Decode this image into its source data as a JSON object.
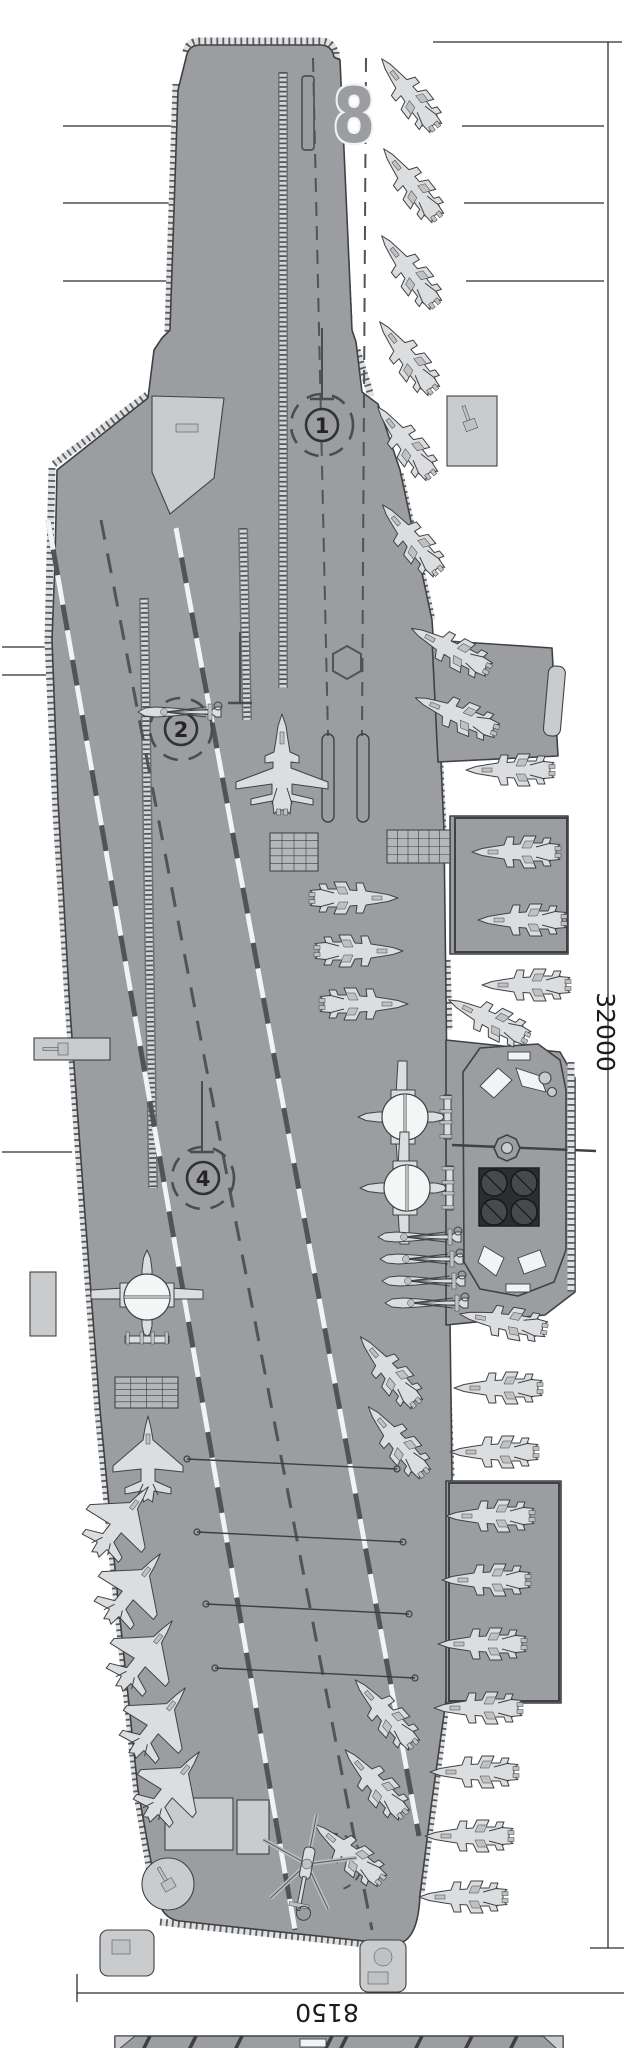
{
  "figure": {
    "title": "aircraft-carrier-flight-deck-plan-top-view",
    "views": [
      "deck-plan",
      "profile-view-cropped-at-bottom"
    ]
  },
  "deck": {
    "bow_number": "8"
  },
  "dimensions": {
    "overall_length": "32000",
    "stern_width": "8150"
  },
  "catapult_spots": [
    {
      "label": "1",
      "x": 322,
      "y": 425,
      "line_x": 322
    },
    {
      "label": "2",
      "x": 181,
      "y": 729,
      "line_x": 240
    },
    {
      "label": "4",
      "x": 203,
      "y": 1178,
      "line_x": 202
    }
  ],
  "colors": {
    "background": "#ffffff",
    "deck": "#9b9da0",
    "deck_light": "#c9cbcd",
    "outline": "#3f4245",
    "aircraft": "#dcdddf",
    "aircraft_shade": "#bfc1c3",
    "marking_white": "#f2f3f4",
    "marking_dark": "#515456",
    "exhaust_block": "#2b2d2e",
    "exhaust_circle": "#47494b"
  },
  "aircraft_inventory": {
    "fighter_wings_folded": 31,
    "fighter_wings_spread": 1,
    "stealth_fighter": 6,
    "aew_radome_aircraft": 3,
    "helicopter_blades_folded": 5,
    "helicopter_rotors_spread": 1
  },
  "aircraft_placements": [
    {
      "t": "flanker_folded",
      "x": 410,
      "y": 95,
      "r": -38
    },
    {
      "t": "flanker_folded",
      "x": 412,
      "y": 185,
      "r": -38
    },
    {
      "t": "flanker_folded",
      "x": 410,
      "y": 272,
      "r": -38
    },
    {
      "t": "flanker_folded",
      "x": 408,
      "y": 358,
      "r": -38
    },
    {
      "t": "flanker_folded",
      "x": 406,
      "y": 443,
      "r": -38
    },
    {
      "t": "flanker_folded",
      "x": 412,
      "y": 540,
      "r": -40
    },
    {
      "t": "flanker_folded",
      "x": 452,
      "y": 650,
      "r": -62
    },
    {
      "t": "flanker_folded",
      "x": 458,
      "y": 715,
      "r": -68
    },
    {
      "t": "flanker_folded",
      "x": 512,
      "y": 770,
      "r": -90
    },
    {
      "t": "flanker_folded",
      "x": 518,
      "y": 852,
      "r": -90
    },
    {
      "t": "flanker_folded",
      "x": 524,
      "y": 920,
      "r": -90
    },
    {
      "t": "flanker_folded",
      "x": 528,
      "y": 985,
      "r": -90
    },
    {
      "t": "flanker_folded",
      "x": 490,
      "y": 1020,
      "r": -64
    },
    {
      "t": "flanker_folded",
      "x": 505,
      "y": 1322,
      "r": -80
    },
    {
      "t": "flanker_folded",
      "x": 500,
      "y": 1388,
      "r": -90
    },
    {
      "t": "flanker_folded",
      "x": 496,
      "y": 1452,
      "r": -90
    },
    {
      "t": "flanker_folded",
      "x": 492,
      "y": 1516,
      "r": -90
    },
    {
      "t": "flanker_folded",
      "x": 488,
      "y": 1580,
      "r": -90
    },
    {
      "t": "flanker_folded",
      "x": 484,
      "y": 1644,
      "r": -90
    },
    {
      "t": "flanker_folded",
      "x": 480,
      "y": 1708,
      "r": -90
    },
    {
      "t": "flanker_folded",
      "x": 476,
      "y": 1772,
      "r": -90
    },
    {
      "t": "flanker_folded",
      "x": 471,
      "y": 1836,
      "r": -90
    },
    {
      "t": "flanker_folded",
      "x": 465,
      "y": 1897,
      "r": -90
    },
    {
      "t": "flanker_folded",
      "x": 390,
      "y": 1372,
      "r": -40
    },
    {
      "t": "flanker_folded",
      "x": 398,
      "y": 1442,
      "r": -40
    },
    {
      "t": "flanker_folded",
      "x": 386,
      "y": 1714,
      "r": -42
    },
    {
      "t": "flanker_folded",
      "x": 376,
      "y": 1784,
      "r": -42
    },
    {
      "t": "flanker_folded",
      "x": 350,
      "y": 1854,
      "r": -50
    },
    {
      "t": "flanker_folded",
      "x": 352,
      "y": 898,
      "r": 90
    },
    {
      "t": "flanker_folded",
      "x": 357,
      "y": 951,
      "r": 90
    },
    {
      "t": "flanker_folded",
      "x": 362,
      "y": 1004,
      "r": 90
    },
    {
      "t": "flanker_spread",
      "x": 282,
      "y": 768,
      "r": 0
    },
    {
      "t": "stealth",
      "x": 148,
      "y": 1462,
      "r": 0
    },
    {
      "t": "stealth",
      "x": 120,
      "y": 1523,
      "r": 38
    },
    {
      "t": "stealth",
      "x": 132,
      "y": 1590,
      "r": 38
    },
    {
      "t": "stealth",
      "x": 144,
      "y": 1657,
      "r": 38
    },
    {
      "t": "stealth",
      "x": 157,
      "y": 1724,
      "r": 38
    },
    {
      "t": "stealth",
      "x": 171,
      "y": 1788,
      "r": 38
    },
    {
      "t": "aew",
      "x": 408,
      "y": 1117,
      "r": -90
    },
    {
      "t": "aew",
      "x": 410,
      "y": 1188,
      "r": -90
    },
    {
      "t": "aew",
      "x": 147,
      "y": 1300,
      "r": 0
    },
    {
      "t": "helo_folded",
      "x": 420,
      "y": 1237,
      "r": -90
    },
    {
      "t": "helo_folded",
      "x": 422,
      "y": 1259,
      "r": -90
    },
    {
      "t": "helo_folded",
      "x": 424,
      "y": 1281,
      "r": -90
    },
    {
      "t": "helo_folded",
      "x": 427,
      "y": 1303,
      "r": -90
    },
    {
      "t": "helo_folded",
      "x": 180,
      "y": 712,
      "r": -90
    },
    {
      "t": "helo_spread",
      "x": 307,
      "y": 1864,
      "r": 11
    }
  ],
  "arresting_wires": [
    {
      "x1": 187,
      "y1": 1459,
      "x2": 397,
      "y2": 1469
    },
    {
      "x1": 197,
      "y1": 1532,
      "x2": 403,
      "y2": 1542
    },
    {
      "x1": 206,
      "y1": 1604,
      "x2": 409,
      "y2": 1614
    },
    {
      "x1": 215,
      "y1": 1668,
      "x2": 415,
      "y2": 1678
    }
  ],
  "callout_lines": [
    {
      "x1": 63,
      "y1": 126,
      "x2": 176,
      "y2": 126
    },
    {
      "x1": 63,
      "y1": 203,
      "x2": 171,
      "y2": 203
    },
    {
      "x1": 63,
      "y1": 281,
      "x2": 167,
      "y2": 281
    },
    {
      "x1": 462,
      "y1": 126,
      "x2": 604,
      "y2": 126
    },
    {
      "x1": 464,
      "y1": 203,
      "x2": 604,
      "y2": 203
    },
    {
      "x1": 466,
      "y1": 281,
      "x2": 604,
      "y2": 281
    },
    {
      "x1": 2,
      "y1": 647,
      "x2": 56,
      "y2": 647
    },
    {
      "x1": 2,
      "y1": 675,
      "x2": 55,
      "y2": 675
    },
    {
      "x1": 2,
      "y1": 1152,
      "x2": 72,
      "y2": 1152
    }
  ],
  "grid_panels": [
    {
      "x": 270,
      "y": 833,
      "w": 48,
      "h": 38,
      "cols": 4,
      "rows": 5
    },
    {
      "x": 387,
      "y": 830,
      "w": 63,
      "h": 33,
      "cols": 6,
      "rows": 4
    },
    {
      "x": 115,
      "y": 1377,
      "w": 63,
      "h": 31,
      "cols": 4,
      "rows": 5
    }
  ]
}
